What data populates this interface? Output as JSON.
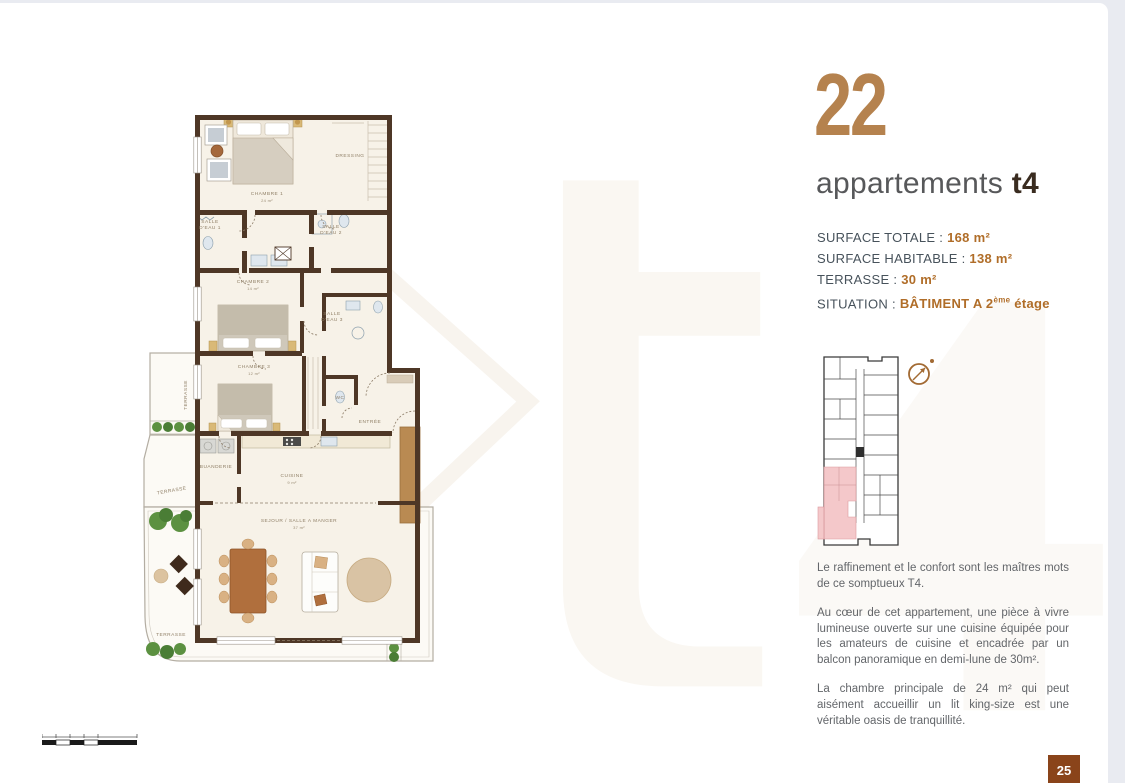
{
  "header": {
    "unit_number": "22",
    "title": "appartements",
    "type_label": "t4"
  },
  "specs": {
    "rows": [
      {
        "label": "SURFACE TOTALE :",
        "value": "168 m²"
      },
      {
        "label": "SURFACE HABITABLE : ",
        "value": "138 m²"
      },
      {
        "label": "TERRASSE :",
        "value": "30 m²"
      },
      {
        "label": "SITUATION :",
        "value_prefix": "BÂTIMENT A 2",
        "value_sup": "ème",
        "value_suffix": " étage"
      }
    ]
  },
  "description": {
    "p1": "Le raffinement et le confort sont les maîtres mots de ce somptueux T4.",
    "p2": "Au cœur de cet appartement, une pièce à vivre lumineuse ouverte sur une cuisine équipée pour les amateurs de cuisine et encadrée par un balcon panoramique en demi-lune de 30m².",
    "p3": "La chambre principale de 24 m² qui peut aisément accueillir un lit king-size est une véritable oasis de tranquillité."
  },
  "plan": {
    "rooms": {
      "chambre1": "CHAMBRE 1",
      "chambre1_area": "24 m²",
      "dressing": "DRESSING",
      "sde1_l1": "SALLE",
      "sde1_l2": "D'EAU 1",
      "sde2_l1": "SALLE",
      "sde2_l2": "D'EAU 2",
      "sde3_l1": "SALLE",
      "sde3_l2": "D'EAU 3",
      "chambre2": "CHAMBRE 2",
      "chambre2_area": "14 m²",
      "chambre3": "CHAMBRE 3",
      "chambre3_area": "12 m²",
      "wc": "WC",
      "entree": "ENTRÉE",
      "buanderie": "BUANDERIE",
      "cuisine": "CUISINE",
      "cuisine_area": "9 m²",
      "sejour": "SEJOUR / SALLE A MANGER",
      "sejour_area": "37 m²",
      "terrasse": "TERRASSE"
    }
  },
  "key_plan": {
    "highlight_color": "#f3c2c4"
  },
  "watermark": {
    "text": "t4"
  },
  "page": {
    "number": "25"
  },
  "colors": {
    "accent_brown": "#b5824e",
    "value_orange": "#b06d28",
    "badge_brown": "#8a441a",
    "wall_brown": "#4e3726"
  }
}
